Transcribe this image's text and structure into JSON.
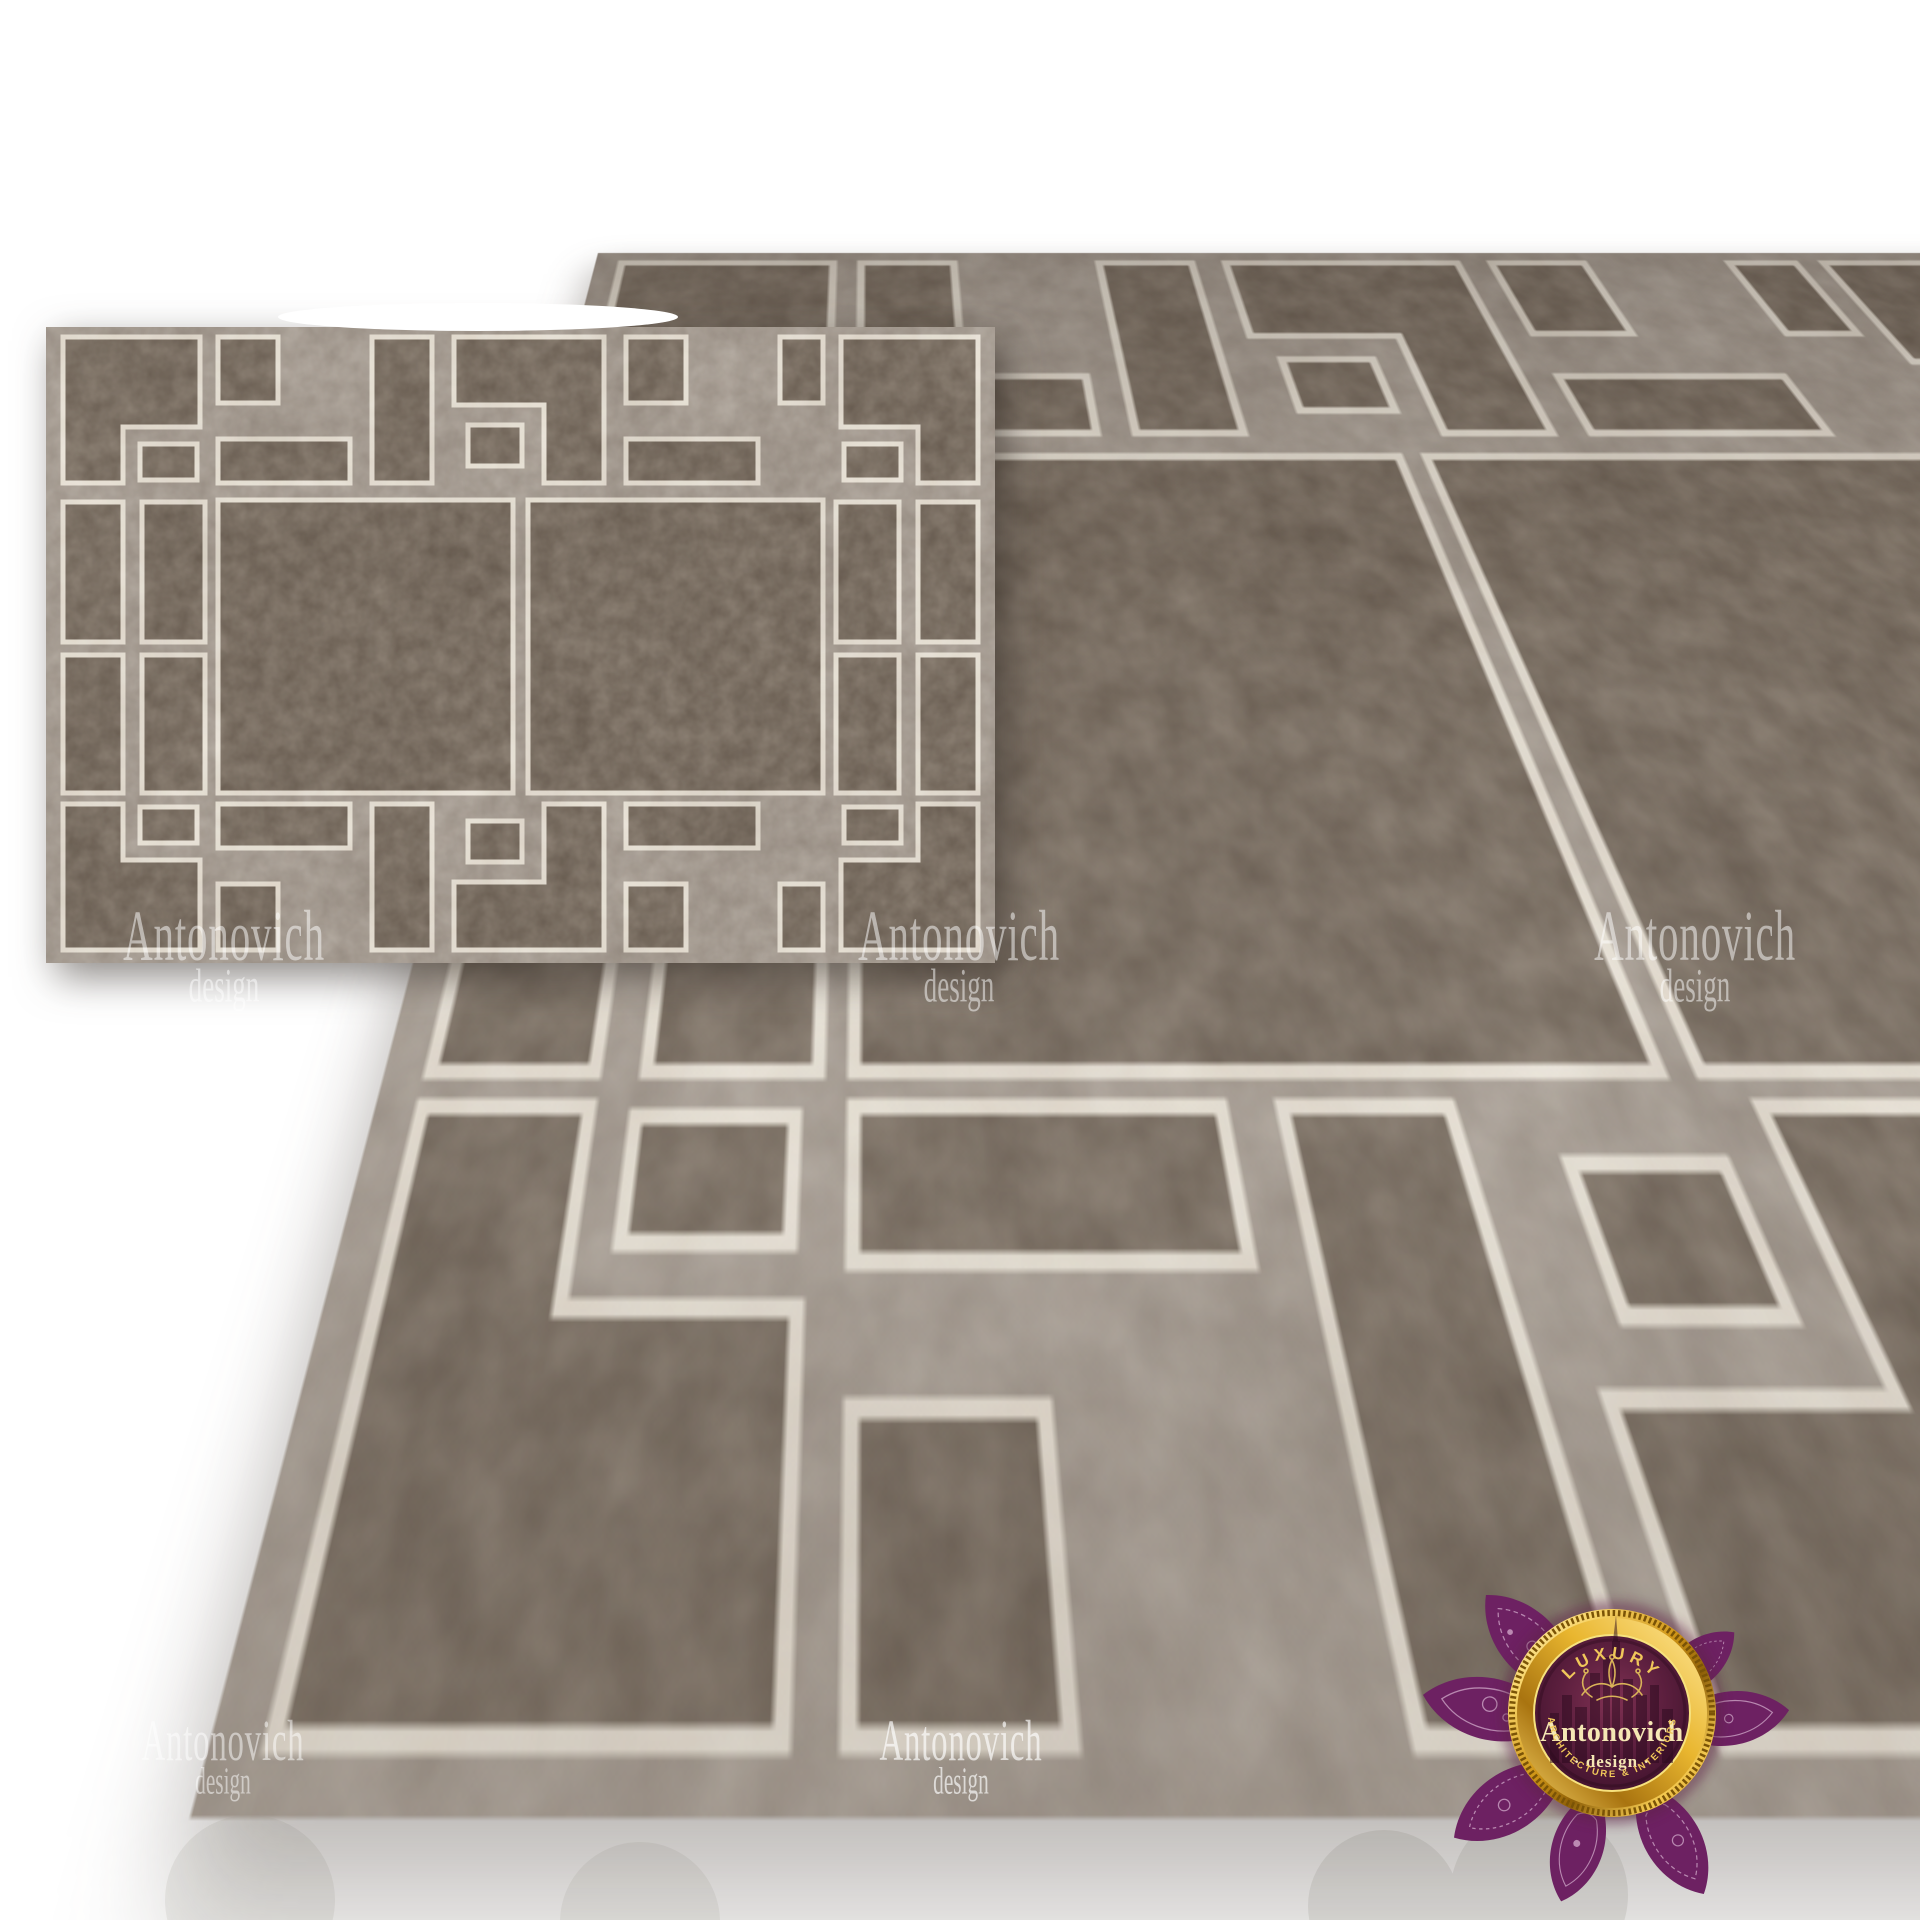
{
  "page": {
    "background_color": "#ffffff",
    "description": "Luxury geometric fret-pattern rug render, flat top view and perspective view"
  },
  "rug": {
    "colors": {
      "field": "#a0968c",
      "blocks": "#6e6256",
      "outline": "#ece5d8"
    },
    "views": [
      {
        "id": "flat-top-view"
      },
      {
        "id": "perspective-view"
      }
    ]
  },
  "watermark": {
    "line1": "Antonovich",
    "line2": "design",
    "color": "#ffffff"
  },
  "logo": {
    "top_text": "LUXURY",
    "brand": "Antonovich",
    "middle_text": "· design ·",
    "bottom_text": "ARCHITECTURE & INTERIORS",
    "colors": {
      "gold": "#f0c75a",
      "cream": "#f5e7b4",
      "lotus_purple": "#6d2162",
      "medallion_maroon": "#4a1430"
    }
  }
}
